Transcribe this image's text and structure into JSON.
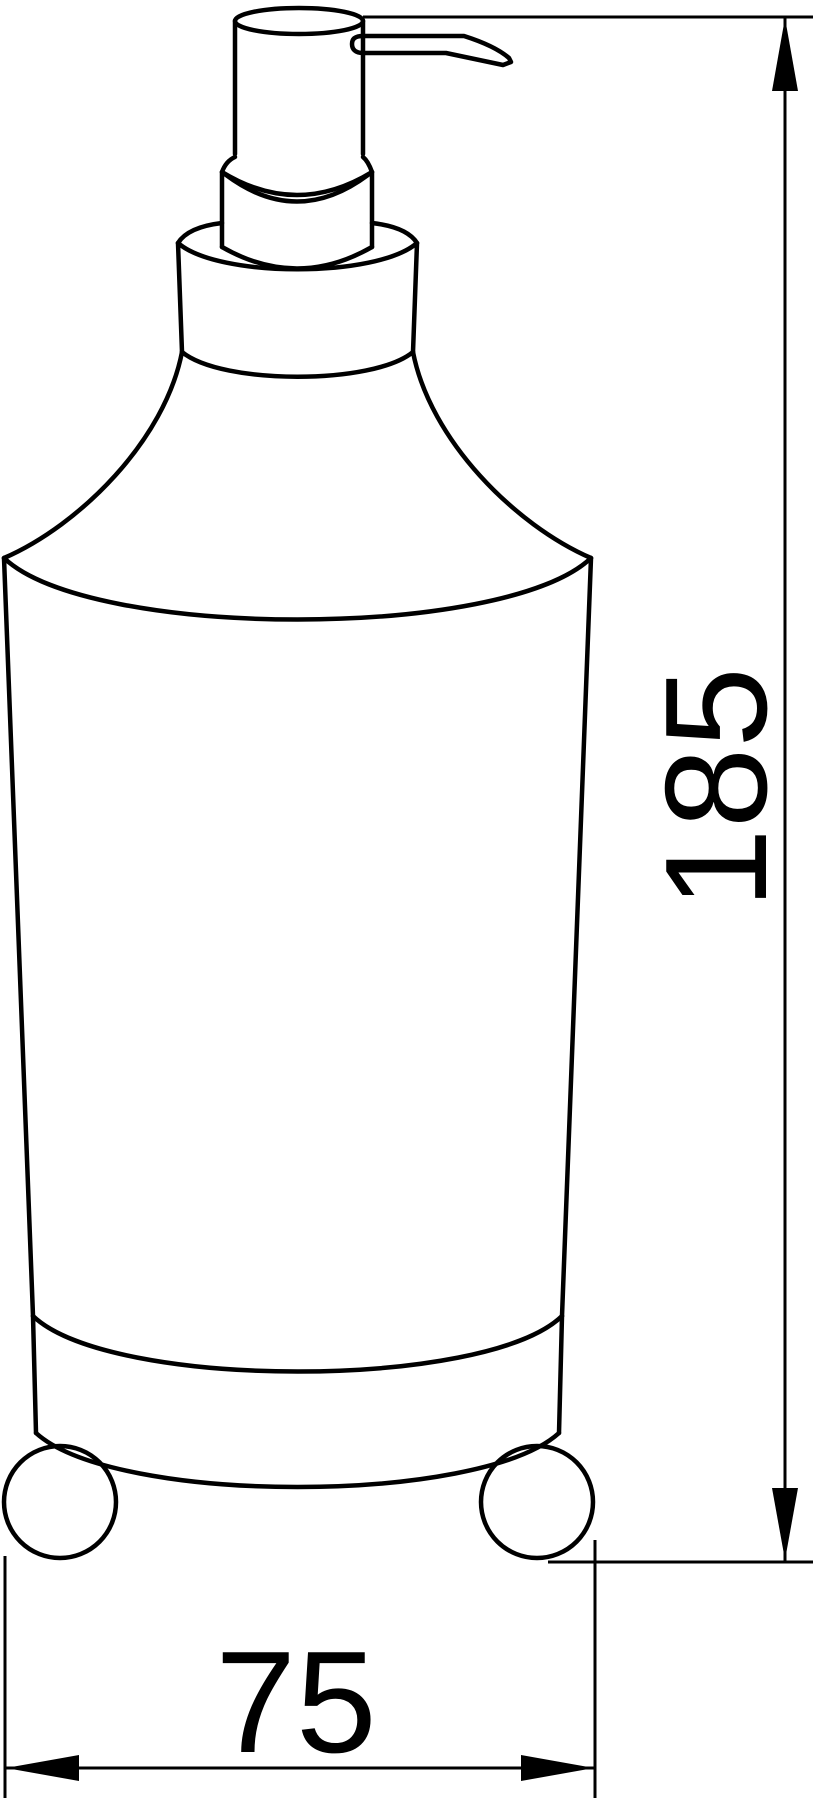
{
  "drawing": {
    "type": "technical-line-drawing",
    "subject": "soap-dispenser-front-view",
    "dimensions": {
      "height": {
        "label": "185"
      },
      "width": {
        "label": "75"
      }
    },
    "style": {
      "ink_color": "#000000",
      "paper_color": "#ffffff"
    }
  }
}
